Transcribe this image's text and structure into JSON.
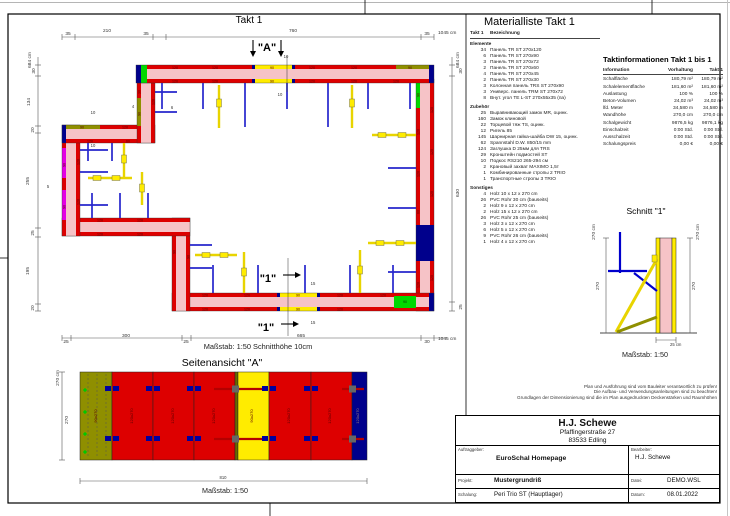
{
  "plan": {
    "title": "Takt 1",
    "scale_text": "Maßstab: 1:50   Schnitthöhe 10cm",
    "labels": [
      {
        "t": "35",
        "x": 68,
        "y": 35
      },
      {
        "t": "210",
        "x": 107,
        "y": 32
      },
      {
        "t": "35",
        "x": 146,
        "y": 35
      },
      {
        "t": "760",
        "x": 293,
        "y": 32
      },
      {
        "t": "35",
        "x": 427,
        "y": 35
      },
      {
        "t": "1045 cm",
        "x": 438,
        "y": 34,
        "a": "s"
      },
      {
        "t": "684 cm",
        "x": 31,
        "y": 60,
        "r": 1
      },
      {
        "t": "30",
        "x": 35,
        "y": 71,
        "r": 1
      },
      {
        "t": "134",
        "x": 30,
        "y": 102,
        "r": 1
      },
      {
        "t": "20",
        "x": 34,
        "y": 130,
        "r": 1
      },
      {
        "t": "255",
        "x": 29,
        "y": 181,
        "r": 1
      },
      {
        "t": "25",
        "x": 34,
        "y": 233,
        "r": 1
      },
      {
        "t": "195",
        "x": 29,
        "y": 271,
        "r": 1
      },
      {
        "t": "20",
        "x": 34,
        "y": 308,
        "r": 1
      },
      {
        "t": "684 cm",
        "x": 459,
        "y": 60,
        "r": 1
      },
      {
        "t": "30",
        "x": 462,
        "y": 71,
        "r": 1
      },
      {
        "t": "630",
        "x": 459,
        "y": 193,
        "r": 1
      },
      {
        "t": "25",
        "x": 462,
        "y": 307,
        "r": 1
      },
      {
        "t": "25",
        "x": 66,
        "y": 343
      },
      {
        "t": "300",
        "x": 126,
        "y": 337
      },
      {
        "t": "25",
        "x": 186,
        "y": 343
      },
      {
        "t": "665",
        "x": 301,
        "y": 337
      },
      {
        "t": "30",
        "x": 427,
        "y": 343
      },
      {
        "t": "1045 cm",
        "x": 438,
        "y": 340,
        "a": "s"
      },
      {
        "t": "\"A\"",
        "x": 267,
        "y": 51,
        "fs": 11,
        "b": 1,
        "c": "#000000"
      },
      {
        "t": "10",
        "x": 286,
        "y": 58,
        "fs": 4.2
      },
      {
        "t": "10",
        "x": 280,
        "y": 96,
        "fs": 4.2
      },
      {
        "t": "\"1\"",
        "x": 268,
        "y": 282,
        "fs": 11,
        "b": 1,
        "c": "#000000"
      },
      {
        "t": "\"1\"",
        "x": 266,
        "y": 331,
        "fs": 11,
        "b": 1,
        "c": "#000000"
      },
      {
        "t": "15",
        "x": 313,
        "y": 285,
        "fs": 4.2
      },
      {
        "t": "15",
        "x": 313,
        "y": 324,
        "fs": 4.2
      },
      {
        "t": "10",
        "x": 93,
        "y": 114,
        "fs": 4.2
      },
      {
        "t": "10",
        "x": 93,
        "y": 147,
        "fs": 4.2
      },
      {
        "t": "4",
        "x": 133,
        "y": 108,
        "fs": 4.2
      },
      {
        "t": "6",
        "x": 172,
        "y": 109,
        "fs": 4.2
      },
      {
        "t": "5",
        "x": 48,
        "y": 188,
        "fs": 4.2
      },
      {
        "t": "120",
        "x": 175,
        "y": 68.8,
        "fs": 3.6,
        "c": "#5a0000"
      },
      {
        "t": "120",
        "x": 215,
        "y": 68.8,
        "fs": 3.6,
        "c": "#5a0000"
      },
      {
        "t": "90",
        "x": 272,
        "y": 68.8,
        "fs": 3.6,
        "c": "#5a0000"
      },
      {
        "t": "120",
        "x": 312,
        "y": 68.8,
        "fs": 3.6,
        "c": "#5a0000"
      },
      {
        "t": "120",
        "x": 354,
        "y": 68.8,
        "fs": 3.6,
        "c": "#5a0000"
      },
      {
        "t": "90",
        "x": 410,
        "y": 68.8,
        "fs": 3.6,
        "c": "#5a0000"
      },
      {
        "t": "120",
        "x": 175,
        "y": 82.6,
        "fs": 3.6,
        "c": "#5a0000"
      },
      {
        "t": "120",
        "x": 215,
        "y": 82.6,
        "fs": 3.6,
        "c": "#5a0000"
      },
      {
        "t": "90",
        "x": 272,
        "y": 82.6,
        "fs": 3.6,
        "c": "#5a0000"
      },
      {
        "t": "120",
        "x": 312,
        "y": 82.6,
        "fs": 3.6,
        "c": "#5a0000"
      },
      {
        "t": "120",
        "x": 354,
        "y": 82.6,
        "fs": 3.6,
        "c": "#5a0000"
      },
      {
        "t": "120",
        "x": 396,
        "y": 82.6,
        "fs": 3.6,
        "c": "#5a0000"
      },
      {
        "t": "120",
        "x": 433.2,
        "y": 110,
        "r": 1,
        "fs": 3.6,
        "c": "#5a0000"
      },
      {
        "t": "120",
        "x": 433.2,
        "y": 152,
        "r": 1,
        "fs": 3.6,
        "c": "#5a0000"
      },
      {
        "t": "120",
        "x": 433.2,
        "y": 194,
        "r": 1,
        "fs": 3.6,
        "c": "#5a0000"
      },
      {
        "t": "120",
        "x": 433.2,
        "y": 278,
        "r": 1,
        "fs": 3.6,
        "c": "#5a0000"
      },
      {
        "t": "90",
        "x": 419.4,
        "y": 95,
        "r": 1,
        "fs": 3.6,
        "c": "#5a0000"
      },
      {
        "t": "120",
        "x": 419.4,
        "y": 132,
        "r": 1,
        "fs": 3.6,
        "c": "#5a0000"
      },
      {
        "t": "120",
        "x": 419.4,
        "y": 174,
        "r": 1,
        "fs": 3.6,
        "c": "#5a0000"
      },
      {
        "t": "60",
        "x": 419.4,
        "y": 212,
        "r": 1,
        "fs": 3.6,
        "c": "#5a0000"
      },
      {
        "t": "120",
        "x": 419.4,
        "y": 285,
        "r": 1,
        "fs": 3.6,
        "c": "#5a0000"
      },
      {
        "t": "120",
        "x": 205,
        "y": 296.6,
        "fs": 3.6,
        "c": "#5a0000"
      },
      {
        "t": "120",
        "x": 247,
        "y": 296.6,
        "fs": 3.6,
        "c": "#5a0000"
      },
      {
        "t": "90",
        "x": 298,
        "y": 296.6,
        "fs": 3.6,
        "c": "#5a0000"
      },
      {
        "t": "120",
        "x": 340,
        "y": 296.6,
        "fs": 3.6,
        "c": "#5a0000"
      },
      {
        "t": "120",
        "x": 383,
        "y": 296.6,
        "fs": 3.6,
        "c": "#5a0000"
      },
      {
        "t": "120",
        "x": 205,
        "y": 310.6,
        "fs": 3.6,
        "c": "#5a0000"
      },
      {
        "t": "120",
        "x": 247,
        "y": 310.6,
        "fs": 3.6,
        "c": "#5a0000"
      },
      {
        "t": "90",
        "x": 298,
        "y": 310.6,
        "fs": 3.6,
        "c": "#5a0000"
      },
      {
        "t": "120",
        "x": 340,
        "y": 310.6,
        "fs": 3.6,
        "c": "#5a0000"
      },
      {
        "t": "90",
        "x": 405,
        "y": 303,
        "fs": 3.6,
        "c": "#003300"
      },
      {
        "t": "90",
        "x": 175.4,
        "y": 252,
        "r": 1,
        "fs": 3.6,
        "c": "#5a0000"
      },
      {
        "t": "90",
        "x": 189.4,
        "y": 257,
        "r": 1,
        "fs": 3.6,
        "c": "#5a0000"
      },
      {
        "t": "120",
        "x": 100,
        "y": 221.6,
        "fs": 3.6,
        "c": "#5a0000"
      },
      {
        "t": "120",
        "x": 140,
        "y": 221.6,
        "fs": 3.6,
        "c": "#5a0000"
      },
      {
        "t": "120",
        "x": 100,
        "y": 235.6,
        "fs": 3.6,
        "c": "#5a0000"
      },
      {
        "t": "120",
        "x": 140,
        "y": 235.6,
        "fs": 3.6,
        "c": "#5a0000"
      },
      {
        "t": "90",
        "x": 65.4,
        "y": 165,
        "r": 1,
        "fs": 3.6,
        "c": "#5a0000"
      },
      {
        "t": "90",
        "x": 65.4,
        "y": 207,
        "r": 1,
        "fs": 3.6,
        "c": "#5a0000"
      },
      {
        "t": "120",
        "x": 79.4,
        "y": 162,
        "r": 1,
        "fs": 3.6,
        "c": "#5a0000"
      },
      {
        "t": "120",
        "x": 79.4,
        "y": 202,
        "r": 1,
        "fs": 3.6,
        "c": "#5a0000"
      },
      {
        "t": "90",
        "x": 82,
        "y": 128.6,
        "fs": 3.6,
        "c": "#5a0000"
      },
      {
        "t": "120",
        "x": 125,
        "y": 128.6,
        "fs": 3.6,
        "c": "#5a0000"
      },
      {
        "t": "120",
        "x": 90,
        "y": 142.6,
        "fs": 3.6,
        "c": "#5a0000"
      },
      {
        "t": "60",
        "x": 128,
        "y": 142.6,
        "fs": 3.6,
        "c": "#5a0000"
      },
      {
        "t": "30",
        "x": 140.4,
        "y": 92,
        "r": 1,
        "fs": 3.6,
        "c": "#5a0000"
      },
      {
        "t": "90",
        "x": 140.4,
        "y": 114,
        "r": 1,
        "fs": 3.6,
        "c": "#5a0000"
      },
      {
        "t": "120",
        "x": 154.4,
        "y": 102,
        "r": 1,
        "fs": 3.6,
        "c": "#5a0000"
      }
    ]
  },
  "side_view": {
    "title": "Seitenansicht \"A\"",
    "scale": "Maßstab: 1:50",
    "labels": [
      {
        "t": "270 cm",
        "x": 59,
        "y": 378,
        "r": 1
      },
      {
        "t": "270",
        "x": 68,
        "y": 420,
        "r": 1
      },
      {
        "t": "810",
        "x": 223,
        "y": 479,
        "fs": 4.2
      },
      {
        "t": "90x270",
        "x": 97,
        "y": 416,
        "r": 1,
        "fs": 4,
        "c": "#5a0000"
      },
      {
        "t": "120x270",
        "x": 133,
        "y": 416,
        "r": 1,
        "fs": 4,
        "c": "#5a0000"
      },
      {
        "t": "120x270",
        "x": 174,
        "y": 416,
        "r": 1,
        "fs": 4,
        "c": "#5a0000"
      },
      {
        "t": "120x270",
        "x": 215,
        "y": 416,
        "r": 1,
        "fs": 4,
        "c": "#5a0000"
      },
      {
        "t": "90x270",
        "x": 253,
        "y": 416,
        "r": 1,
        "fs": 4,
        "c": "#5a0000"
      },
      {
        "t": "120x270",
        "x": 290,
        "y": 416,
        "r": 1,
        "fs": 4,
        "c": "#5a0000"
      },
      {
        "t": "120x270",
        "x": 331,
        "y": 416,
        "r": 1,
        "fs": 4,
        "c": "#5a0000"
      },
      {
        "t": "120x270",
        "x": 359,
        "y": 416,
        "r": 1,
        "fs": 4,
        "c": "#9a7a7a"
      }
    ]
  },
  "section": {
    "title": "Schnitt  \"1\"",
    "scale": "Maßstab: 1:50",
    "labels": [
      {
        "t": "270 cm",
        "x": 595,
        "y": 232,
        "r": 1
      },
      {
        "t": "270",
        "x": 599,
        "y": 286,
        "r": 1
      },
      {
        "t": "270 cm",
        "x": 699,
        "y": 232,
        "r": 1
      },
      {
        "t": "270",
        "x": 695,
        "y": 286,
        "r": 1
      },
      {
        "t": "25 cm",
        "x": 670,
        "y": 346,
        "fs": 4.2,
        "a": "s"
      }
    ]
  },
  "material_list": {
    "title": "Materialliste  Takt 1",
    "qty_header": "Takt 1",
    "name_header": "Bezeichnung",
    "groups": [
      {
        "name": "Elemente",
        "items": [
          [
            "34",
            "Панель TR ST 270x120"
          ],
          [
            "6",
            "Панель TR ST 270x90"
          ],
          [
            "3",
            "Панель TR ST 270x72"
          ],
          [
            "2",
            "Панель TR ST 270x60"
          ],
          [
            "4",
            "Панель TR ST 270x45"
          ],
          [
            "2",
            "Панель TR ST 270x30"
          ],
          [
            "3",
            "Колонная панель TRS ST 270x90"
          ],
          [
            "3",
            "Универс. панель TRM ST 270x72"
          ],
          [
            "8",
            "Внут. угол TE L-ST 270x55x35 (па)"
          ]
        ]
      },
      {
        "name": "Zubehör",
        "items": [
          [
            "25",
            "Выравнивающий замок MR, оцинк."
          ],
          [
            "160",
            "Замок клиновой"
          ],
          [
            "22",
            "Торцевой тяж TS, оцинк."
          ],
          [
            "12",
            "Ригель 85"
          ],
          [
            "145",
            "Шарнирная гайка-шайба DW 15, оцинк."
          ],
          [
            "62",
            "Spannstahl  D.W. 850/15 mm"
          ],
          [
            "124",
            "Заглушка D 25мм для TRS"
          ],
          [
            "29",
            "Кронштейн подмостей ST"
          ],
          [
            "10",
            "Подкос RS210  265-294 см"
          ],
          [
            "2",
            "Крановый захват MAXIMO 1,5т"
          ],
          [
            "1",
            "Комбинированные стропы 2 TRIO"
          ],
          [
            "1",
            "Транспортные стропы 3 TRIO"
          ]
        ]
      },
      {
        "name": "Sonstiges",
        "items": [
          [
            "4",
            "Holz 10 x 12 x 270 cm"
          ],
          [
            "26",
            "PVC Rohr 30 cm (bauseits)"
          ],
          [
            "2",
            "Holz 9 x 12 x 270 cm"
          ],
          [
            "2",
            "Holz 15 x 12 x 270 cm"
          ],
          [
            "26",
            "PVC Rohr 25 cm (bauseits)"
          ],
          [
            "3",
            "Holz 3 x 12 x 270 cm"
          ],
          [
            "6",
            "Holz 5 x 12 x 270 cm"
          ],
          [
            "9",
            "PVC Rohr 26 cm (bauseits)"
          ],
          [
            "1",
            "Holz 4 x 12 x 270 cm"
          ]
        ]
      }
    ]
  },
  "takt_info": {
    "title": "Taktinformationen  Takt 1 bis 1",
    "headers": [
      "Information",
      "Vorhaltung",
      "Takt 1"
    ],
    "rows": [
      [
        "Schalfläche",
        "180,79 m²",
        "180,79 m²"
      ],
      [
        "Schalelementfläche",
        "181,60 m²",
        "181,60 m²"
      ],
      [
        "Auslastung",
        "100 %",
        "100 %"
      ],
      [
        "Beton-Volumen",
        "24,02 m³",
        "24,02 m³"
      ],
      [
        "lfd. Meter",
        "34,580 m",
        "34,580 m"
      ],
      [
        "Wandhöhe",
        "270,0 cm",
        "270,0 cm"
      ],
      [
        "Schalgewicht",
        "9876,5 kg",
        "9876,1 kg"
      ],
      [
        "Einschalzeit",
        "0:00 Std.",
        "0:00 Std."
      ],
      [
        "Ausschalzeit",
        "0:00 Std.",
        "0:00 Std."
      ],
      [
        "Schalungspreis",
        "0,00 €",
        "0,00 €"
      ]
    ]
  },
  "notes": [
    "Plan und Ausführung sind vom Bauleiter verantwortlich zu prüfen!",
    "Die Aufbau- und Verwendungsanleitungen sind zu beachten!",
    "Grundlagen der Dimensionierung sind die im Plan ausgedruckten Deckenstärken und Raumhöhen"
  ],
  "title_block": {
    "company": "H.J. Schewe",
    "street": "Pfaffingerstraße 27",
    "city": "83533 Edling",
    "auftraggeber_label": "Auftraggeber:",
    "auftraggeber": "EuroSchal Homepage",
    "bearbeiter_label": "Bearbeiter:",
    "bearbeiter": "H.J. Schewe",
    "projekt_label": "Projekt:",
    "projekt": "Mustergrundriß",
    "datei_label": "Datei:",
    "datei": "DEMO.WSL",
    "schalung_label": "Schalung:",
    "schalung": "Peri Trio ST (Hauptlager)",
    "datum_label": "Datum:",
    "datum": "08.01.2022"
  },
  "colors": {
    "panel_red": "#dd0000",
    "wall_pink": "#f6c3c7",
    "navy": "#00008c",
    "green": "#00d800",
    "olive": "#8f8f00",
    "magenta": "#e400e4",
    "yellow": "#ffec00",
    "brace_blue": "#2626cc"
  }
}
